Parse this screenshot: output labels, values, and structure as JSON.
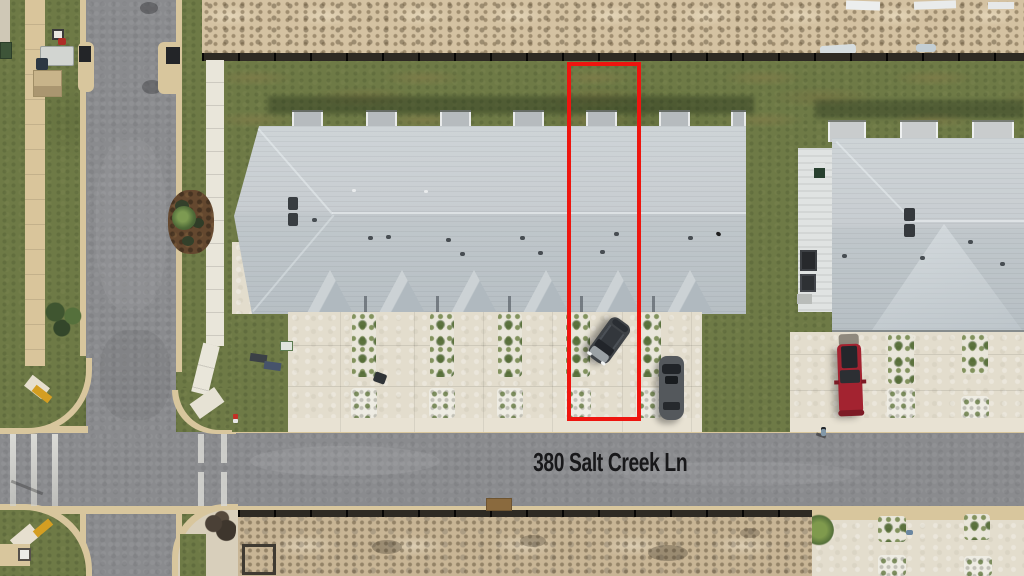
{
  "scene": {
    "type": "aerial-drone-photo",
    "description": "Aerial view of townhome community with one lot outlined in red",
    "street_label": "380 Salt Creek Ln"
  },
  "colors": {
    "highlight_red": "#ee150f",
    "street_label_color": "#18181a",
    "asphalt_gray": "#8a8b8e",
    "roof_gray": "#c4cacf",
    "grass_green": "#6e7a46",
    "dirt_sand": "#d4c2a2",
    "concrete": "#e3ddcd",
    "curb_tan": "#d8c69d",
    "red_truck": "#a32330",
    "dark_suv": "#3f4347",
    "gray_suv": "#54585c"
  }
}
